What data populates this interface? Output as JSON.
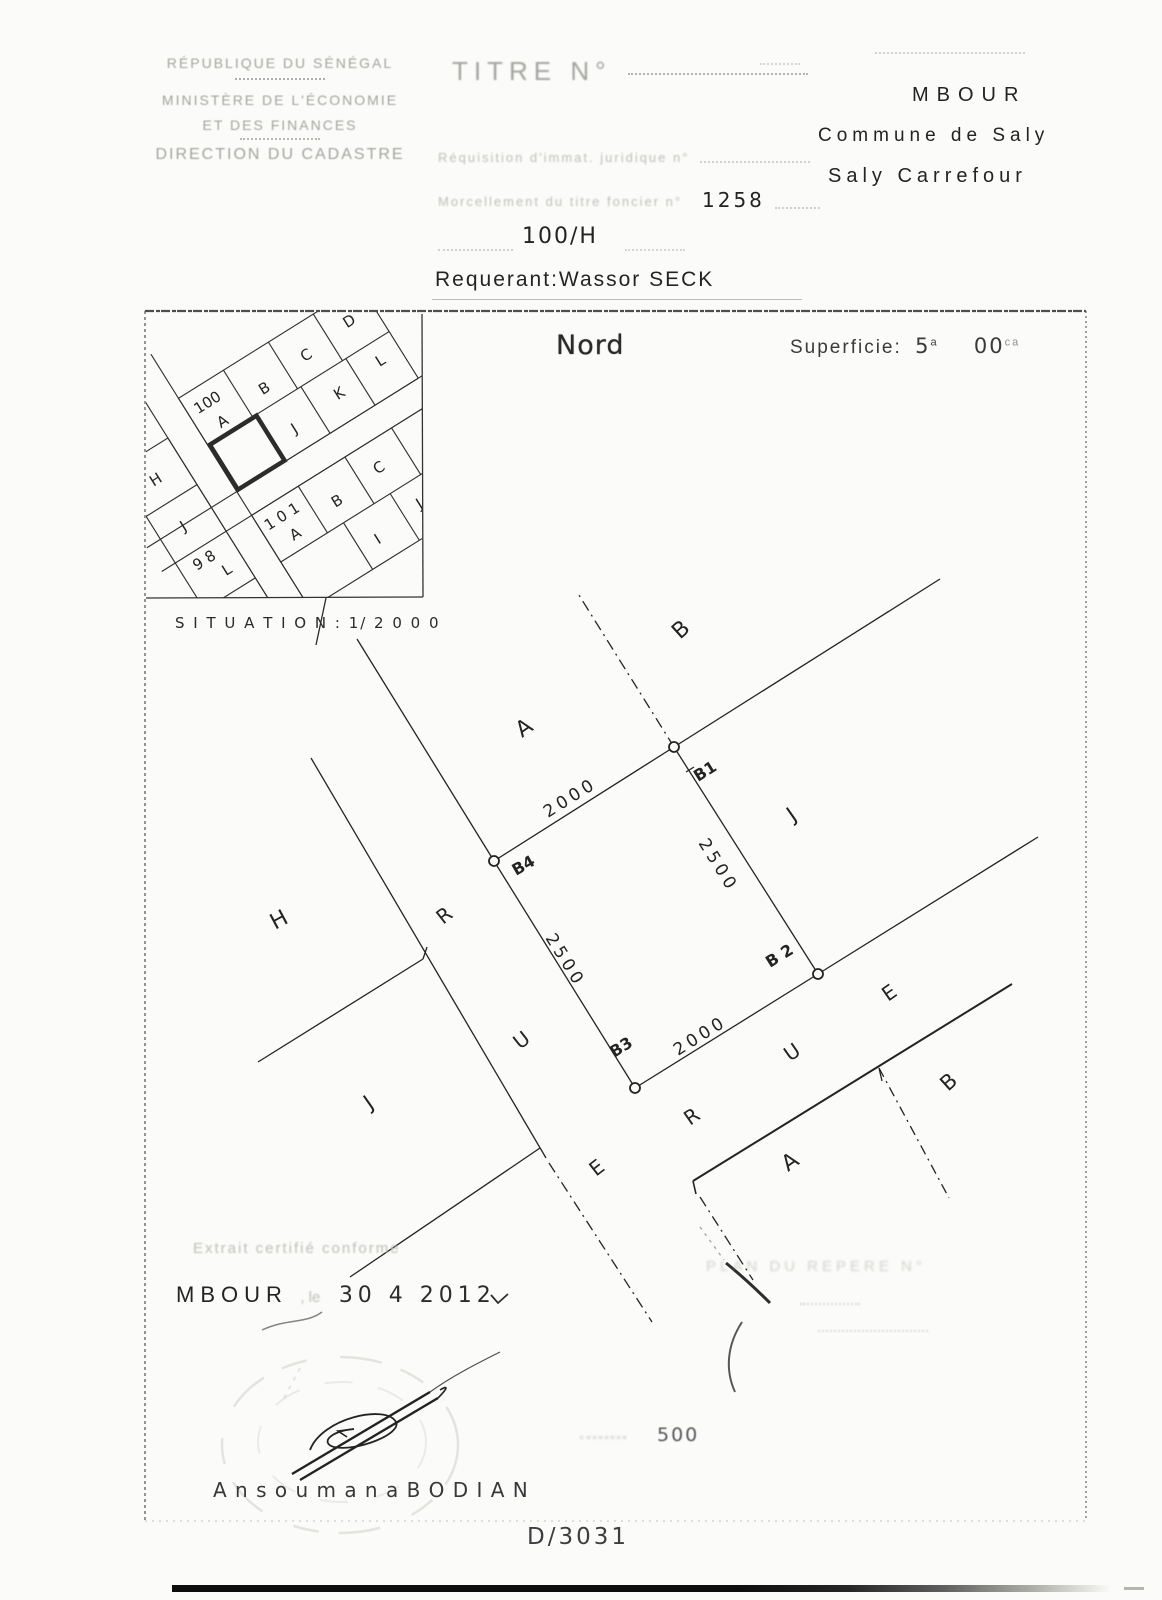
{
  "header": {
    "republic": "RÉPUBLIQUE DU SÉNÉGAL",
    "ministry": "MINISTÈRE DE L'ÉCONOMIE",
    "ministry2": "ET DES FINANCES",
    "direction": "DIRECTION DU CADASTRE",
    "titre_label": "TITRE N°",
    "requisition_label": "Réquisition d'immat. juridique n°",
    "morcellement_label": "Morcellement du titre foncier n°",
    "titre_foncier_no": "1258",
    "lot_no": "100/H",
    "requerant": "Requerant:Wassor SECK",
    "city": "MBOUR",
    "commune": "Commune de Saly",
    "quartier": "Saly Carrefour"
  },
  "plan": {
    "north": "Nord",
    "superficie_label": "Superficie:",
    "superficie_a": "5",
    "superficie_a_unit": "a",
    "superficie_ca": "00",
    "superficie_ca_unit": "ca",
    "inset": {
      "caption": "S I T U A T I O N :  1/ 2 0 0 0",
      "n100": "100",
      "a100": "A",
      "b100": "B",
      "c100": "C",
      "d100": "D",
      "j100": "J",
      "k100": "K",
      "l100": "L",
      "h98": "H",
      "j98": "J",
      "n98": "9 8",
      "l98": "L",
      "k98": "K",
      "n101": "1 0 1",
      "a101": "A",
      "b101": "B",
      "c101": "C",
      "i101": "I",
      "j101": "J"
    },
    "corners": {
      "b1": "B1",
      "b2": "B 2",
      "b3": "B3",
      "b4": "B4"
    },
    "dims": {
      "top": "2000",
      "right": "2500",
      "left": "2500",
      "bottom": "2000"
    },
    "parcels": {
      "a_top": "A",
      "b_top": "B",
      "j_right": "J",
      "h_left": "H",
      "j_left": "J",
      "a_bottom": "A",
      "b_bottom": "B"
    },
    "rue_left": {
      "r": "R",
      "u": "U",
      "e": "E"
    },
    "rue_bottom": {
      "r": "R",
      "u": "U",
      "e": "E"
    }
  },
  "footer": {
    "certify": "Extrait certifié conforme",
    "place": "MBOUR",
    "le": ", le",
    "date": "30  4  2012",
    "signer": "A n s o u m a n a  B O D I A N",
    "scale": "500",
    "doc_no": "D/3031",
    "faint_plan_note": "PLAN DU REPERE N°"
  }
}
